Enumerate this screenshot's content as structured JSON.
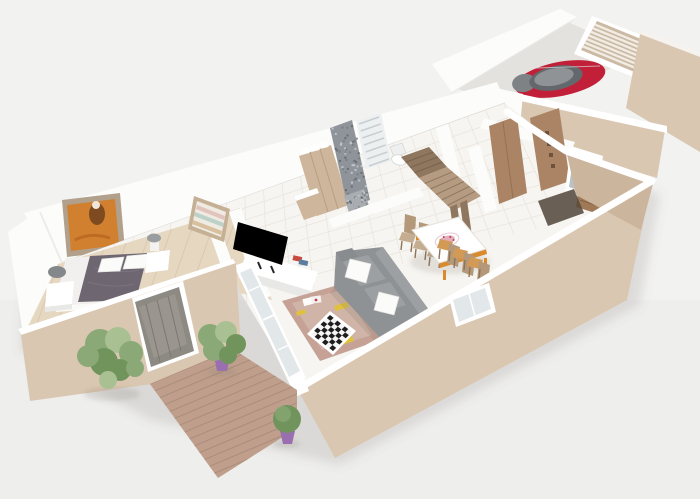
{
  "meta": {
    "kind": "3d-floorplan-render",
    "width": 700,
    "height": 499,
    "visible_text": "none"
  },
  "colors": {
    "bg": "#f2f2f1",
    "wall_white": "#fcfcfb",
    "wall_shade": "#e8e8e6",
    "wall_edge": "#d8d5d0",
    "wall_ext": "#dac7b1",
    "wall_ext_dark": "#ccb59d",
    "floor": "#f7f5f1",
    "tile": "#e8e3db",
    "wood_floor": "#e6d7c1",
    "wood_floor_line": "#d2bfa4",
    "deck": "#bf9f8b",
    "deck_line": "#a7887a",
    "rug": "#c6a296",
    "rug_light": "#d6beb1",
    "rug_yellow": "#dfc13e",
    "sofa": "#8f9295",
    "sofa_light": "#9da0a3",
    "sofa_dark": "#7e8184",
    "pillow": "#fbfbfa",
    "duvet": "#6e6671",
    "duvet_light": "#837b87",
    "art_orange": "#d0802f",
    "art_dark": "#7e4a20",
    "frame": "#b1a18c",
    "shelf_wood": "#c6b095",
    "wood": "#cdb69b",
    "wood_dark": "#ad9274",
    "front_door": "#8d8a83",
    "entry_door": "#ab8466",
    "entry_door_dark": "#6e523c",
    "doorway_dark": "#564a3e",
    "stairs": "#b49b82",
    "stairs_dark": "#8e765f",
    "chair": "#b39879",
    "chair_light": "#c4ad90",
    "chair_dark": "#8f7557",
    "seat_orange": "#d29a55",
    "table_orange": "#d98a2c",
    "plate_pink": "#e3aebd",
    "plate_red": "#c23a52",
    "car_red": "#c12038",
    "car_gray": "#8f9396",
    "car_dark": "#63686c",
    "slat": "#cbb9a3",
    "slat_light": "#f1ece4",
    "mosaic": "#8e949a",
    "mosaic_dark": "#5f666d",
    "mosaic_light": "#c7ccd1",
    "radiator": "#edf0f1",
    "radiator_line": "#c7ced2",
    "mirror": "#b9c2c6",
    "console_wood": "#a07a57",
    "plant": "#8ba976",
    "plant_dark": "#71945d",
    "plant_light": "#a9c192",
    "pot": "#9a6fb0",
    "pot_dark": "#7d5795",
    "trunk": "#8b7b60",
    "glass": "#e2e7e9",
    "white": "#ffffff",
    "shadow": "rgba(110,104,96,0.16)"
  },
  "scene": {
    "rooms": [
      "bedroom",
      "dressing",
      "bathroom",
      "living-room",
      "dining-area",
      "entry-hall",
      "garage",
      "terrace"
    ],
    "objects": [
      {
        "name": "double-bed",
        "color": "#6e6671"
      },
      {
        "name": "nightstand-left",
        "color": "#ffffff"
      },
      {
        "name": "nightstand-right",
        "color": "#ffffff"
      },
      {
        "name": "wall-artwork",
        "color": "#d0802f"
      },
      {
        "name": "dressing-shelves",
        "color": "#c6b095"
      },
      {
        "name": "wardrobe",
        "color": "#cdb69b"
      },
      {
        "name": "shower-mosaic-wall",
        "color": "#8e949a"
      },
      {
        "name": "towel-radiator",
        "color": "#edf0f1"
      },
      {
        "name": "toilet",
        "color": "#ffffff"
      },
      {
        "name": "staircase",
        "color": "#b49b82"
      },
      {
        "name": "flat-screen-tv",
        "color": "#17191d"
      },
      {
        "name": "tv-console",
        "color": "#ffffff"
      },
      {
        "name": "corner-sofa",
        "color": "#8f9295"
      },
      {
        "name": "area-rug",
        "color": "#c6a296"
      },
      {
        "name": "chessboard",
        "color": "#1d1d1d"
      },
      {
        "name": "dining-table",
        "color": "#ffffff",
        "accent": "#d98a2c"
      },
      {
        "name": "dining-chairs",
        "count": 6,
        "color": "#b39879"
      },
      {
        "name": "decorative-plate",
        "color": "#c23a52"
      },
      {
        "name": "entry-doors",
        "count": 2,
        "color": "#ab8466"
      },
      {
        "name": "wall-mirror",
        "color": "#b9c2c6"
      },
      {
        "name": "entry-console",
        "color": "#a07a57"
      },
      {
        "name": "red-car",
        "color": "#c12038"
      },
      {
        "name": "garage-door",
        "color": "#cbb9a3"
      },
      {
        "name": "front-door",
        "color": "#8d8a83"
      },
      {
        "name": "french-windows",
        "color": "#e2e7e9"
      },
      {
        "name": "wood-deck",
        "color": "#bf9f8b"
      },
      {
        "name": "tree",
        "color": "#8ba976"
      },
      {
        "name": "potted-plant",
        "pot_color": "#9a6fb0"
      },
      {
        "name": "round-bush",
        "color": "#71945d"
      }
    ]
  }
}
